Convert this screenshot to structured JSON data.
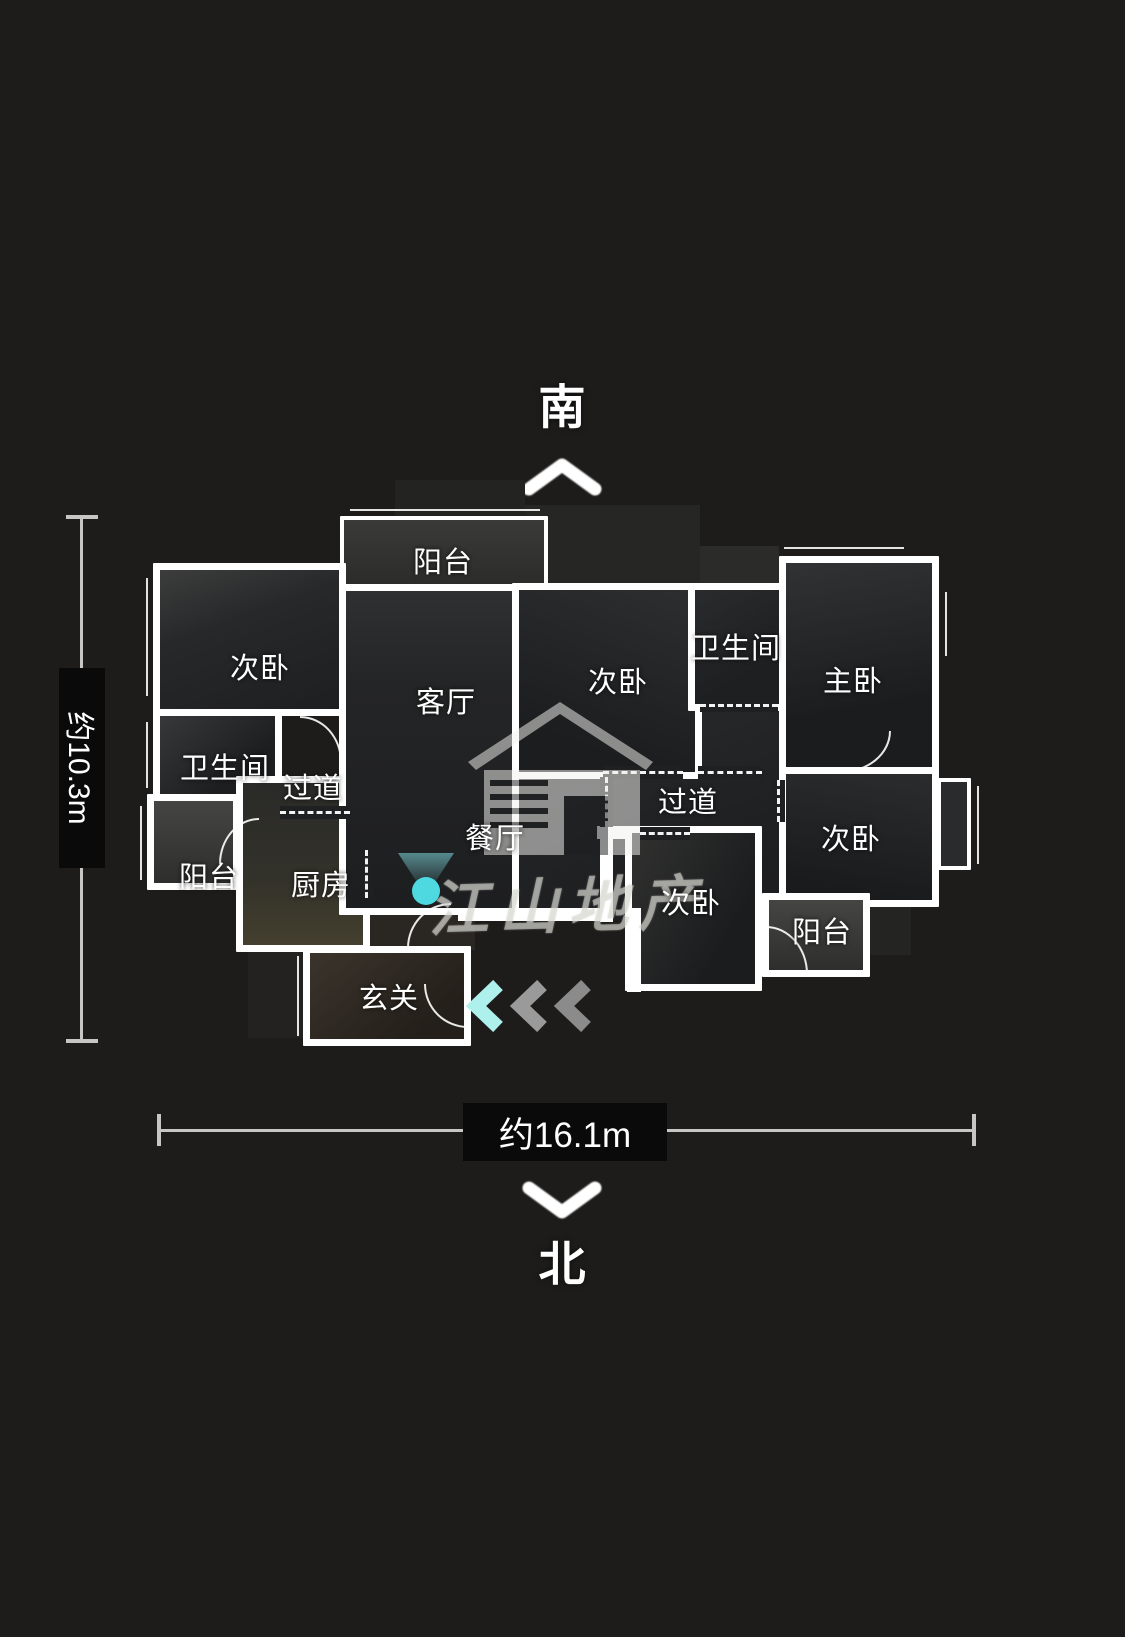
{
  "compass": {
    "south": "南",
    "north": "北"
  },
  "dimensions": {
    "width": "约16.1m",
    "depth": "约10.3m"
  },
  "watermark": {
    "brand": "江山地产",
    "logo": "house-logo"
  },
  "rooms": {
    "balcony_top": {
      "label": "阳台"
    },
    "bedroom_tl": {
      "label": "次卧"
    },
    "living_room": {
      "label": "客厅"
    },
    "bedroom_center": {
      "label": "次卧"
    },
    "bathroom_right": {
      "label": "卫生间"
    },
    "master_bedroom": {
      "label": "主卧"
    },
    "hallway_right": {
      "label": "过道"
    },
    "bedroom_right": {
      "label": "次卧"
    },
    "balcony_right": {
      "label": "阳台"
    },
    "bedroom_bottom": {
      "label": "次卧"
    },
    "dining_room": {
      "label": "餐厅"
    },
    "hallway_left": {
      "label": "过道"
    },
    "bathroom_left": {
      "label": "卫生间"
    },
    "balcony_left": {
      "label": "阳台"
    },
    "kitchen": {
      "label": "厨房"
    },
    "foyer": {
      "label": "玄关"
    }
  },
  "icons": {
    "camera_marker": "camera-position-dot",
    "entry_arrows": "triple-left-chevrons",
    "compass_up": "up-chevron",
    "compass_down": "down-chevron"
  },
  "colors": {
    "background": "#1d1c1b",
    "wall": "#ffffff",
    "accent_cyan": "#4ed9e0",
    "chevron_gray": "#919191",
    "dimension_gray": "#c6c6c6"
  }
}
